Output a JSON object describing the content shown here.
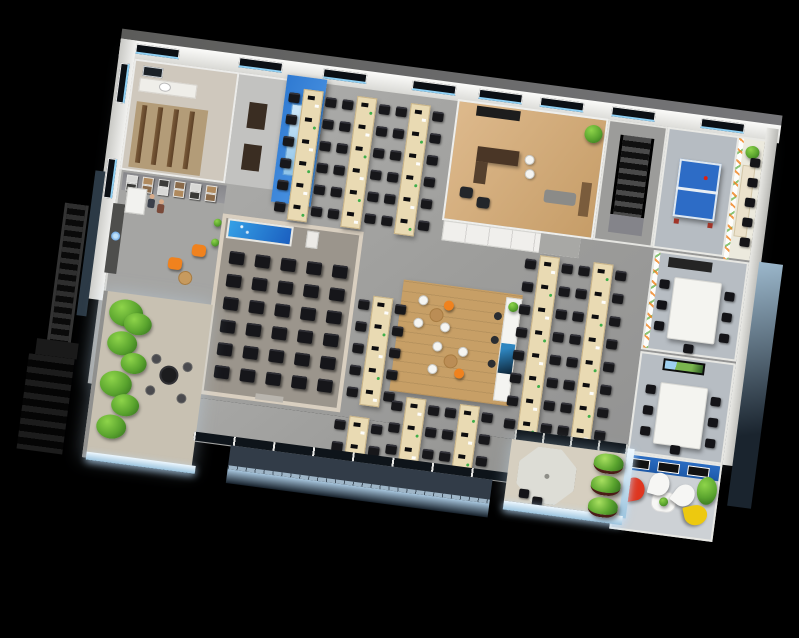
{
  "scene": {
    "description": "3D isometric rendering of a full office floor plan, viewed from above at a slight clockwise rotation, on a pure black background",
    "background": "#000000",
    "rotation_deg": 7.5
  },
  "palette": {
    "bg": "#000000",
    "floor": "#a9a9a7",
    "wall": "#f1f0ee",
    "accentBlue": "#2f7ad2",
    "desk": "#e9dab3",
    "deskEdge": "#c9b488",
    "chair": "#17171a",
    "woodFloor": "#d7b184",
    "islandWood": "#c9a26b",
    "plant": "#5aa42e",
    "plantLight": "#8ed44a",
    "plantDark": "#2f6b1c",
    "orange": "#f0821e",
    "red": "#df3620",
    "yellow": "#edc90f",
    "white": "#f6f6f4",
    "facadeTop": "#a9c8e0",
    "facadeBottom": "#16202a",
    "glow": "#cfeafb"
  },
  "building": {
    "rooms": [
      {
        "id": "washroom",
        "label": "washroom with stalls and sink"
      },
      {
        "id": "corridor",
        "label": "corridor with dark doors"
      },
      {
        "id": "blue-accent-wall",
        "label": "tall blue accent wall with panel"
      },
      {
        "id": "open-office",
        "label": "open plan office with desk rows"
      },
      {
        "id": "executive-office",
        "label": "executive office with wood floor"
      },
      {
        "id": "stairwell",
        "label": "internal staircase"
      },
      {
        "id": "game-room",
        "label": "game room with ping-pong table"
      },
      {
        "id": "focus-room",
        "label": "narrow room with doodle wall and seats"
      },
      {
        "id": "meeting-room-a",
        "label": "meeting room with long white table"
      },
      {
        "id": "meeting-room-b",
        "label": "meeting room with wall TV"
      },
      {
        "id": "creative-lounge",
        "label": "lounge with blue photo wall and petal chairs"
      },
      {
        "id": "reception",
        "label": "reception with gallery wall and orange armchairs"
      },
      {
        "id": "training-room",
        "label": "training room with projection screen and chair rows"
      },
      {
        "id": "garden-terrace",
        "label": "open garden terrace with plants and iron table"
      },
      {
        "id": "break-island",
        "label": "wood floor break area with cafe chairs and counter"
      },
      {
        "id": "balcony",
        "label": "front balcony with railing"
      },
      {
        "id": "umbrella-terrace",
        "label": "terrace with parasol and hedges"
      },
      {
        "id": "exterior-stairs",
        "label": "black exterior escape stairs"
      }
    ]
  },
  "windows": {
    "top_xs": [
      16,
      120,
      205,
      295,
      362,
      424,
      496,
      586
    ],
    "left_ys": [
      24,
      120
    ]
  },
  "washroom": {
    "stalls": 4
  },
  "reception": {
    "gallery_frames": 12,
    "people": 2,
    "armchairs": 2
  },
  "training_room": {
    "chair_rows": 6,
    "chair_cols": 5
  },
  "open_office": {
    "desk_w": 20,
    "desk_blocks": [
      {
        "x": 176,
        "y": 12,
        "cols": 3,
        "gap": 54,
        "modules": 6,
        "mh": 22
      },
      {
        "x": 272,
        "y": 208,
        "cols": 1,
        "gap": 54,
        "modules": 5,
        "mh": 22
      },
      {
        "x": 432,
        "y": 146,
        "cols": 2,
        "gap": 54,
        "modules": 8,
        "mh": 23
      },
      {
        "x": 318,
        "y": 304,
        "cols": 2,
        "gap": 54,
        "modules": 3,
        "mh": 22
      },
      {
        "x": 264,
        "y": 330,
        "cols": 1,
        "gap": 54,
        "modules": 2,
        "mh": 22
      }
    ]
  },
  "meeting_room_a": {
    "chairs_left": 3,
    "chairs_right": 3,
    "chairs_end": 1
  },
  "meeting_room_b": {
    "chairs_left": 3,
    "chairs_right": 3,
    "chairs_end": 1
  },
  "creative_lounge": {
    "frames": 3,
    "petal_chairs": [
      "red",
      "white",
      "white",
      "yellow"
    ]
  },
  "garden_terrace": {
    "plant_blobs": 7,
    "iron_chairs": 4
  },
  "umbrella_terrace": {
    "hedges": 3,
    "umbrella_panels": 8
  },
  "break_island": {
    "clusters": 2,
    "stools": 3
  },
  "focus_room": {
    "seats": 5
  }
}
